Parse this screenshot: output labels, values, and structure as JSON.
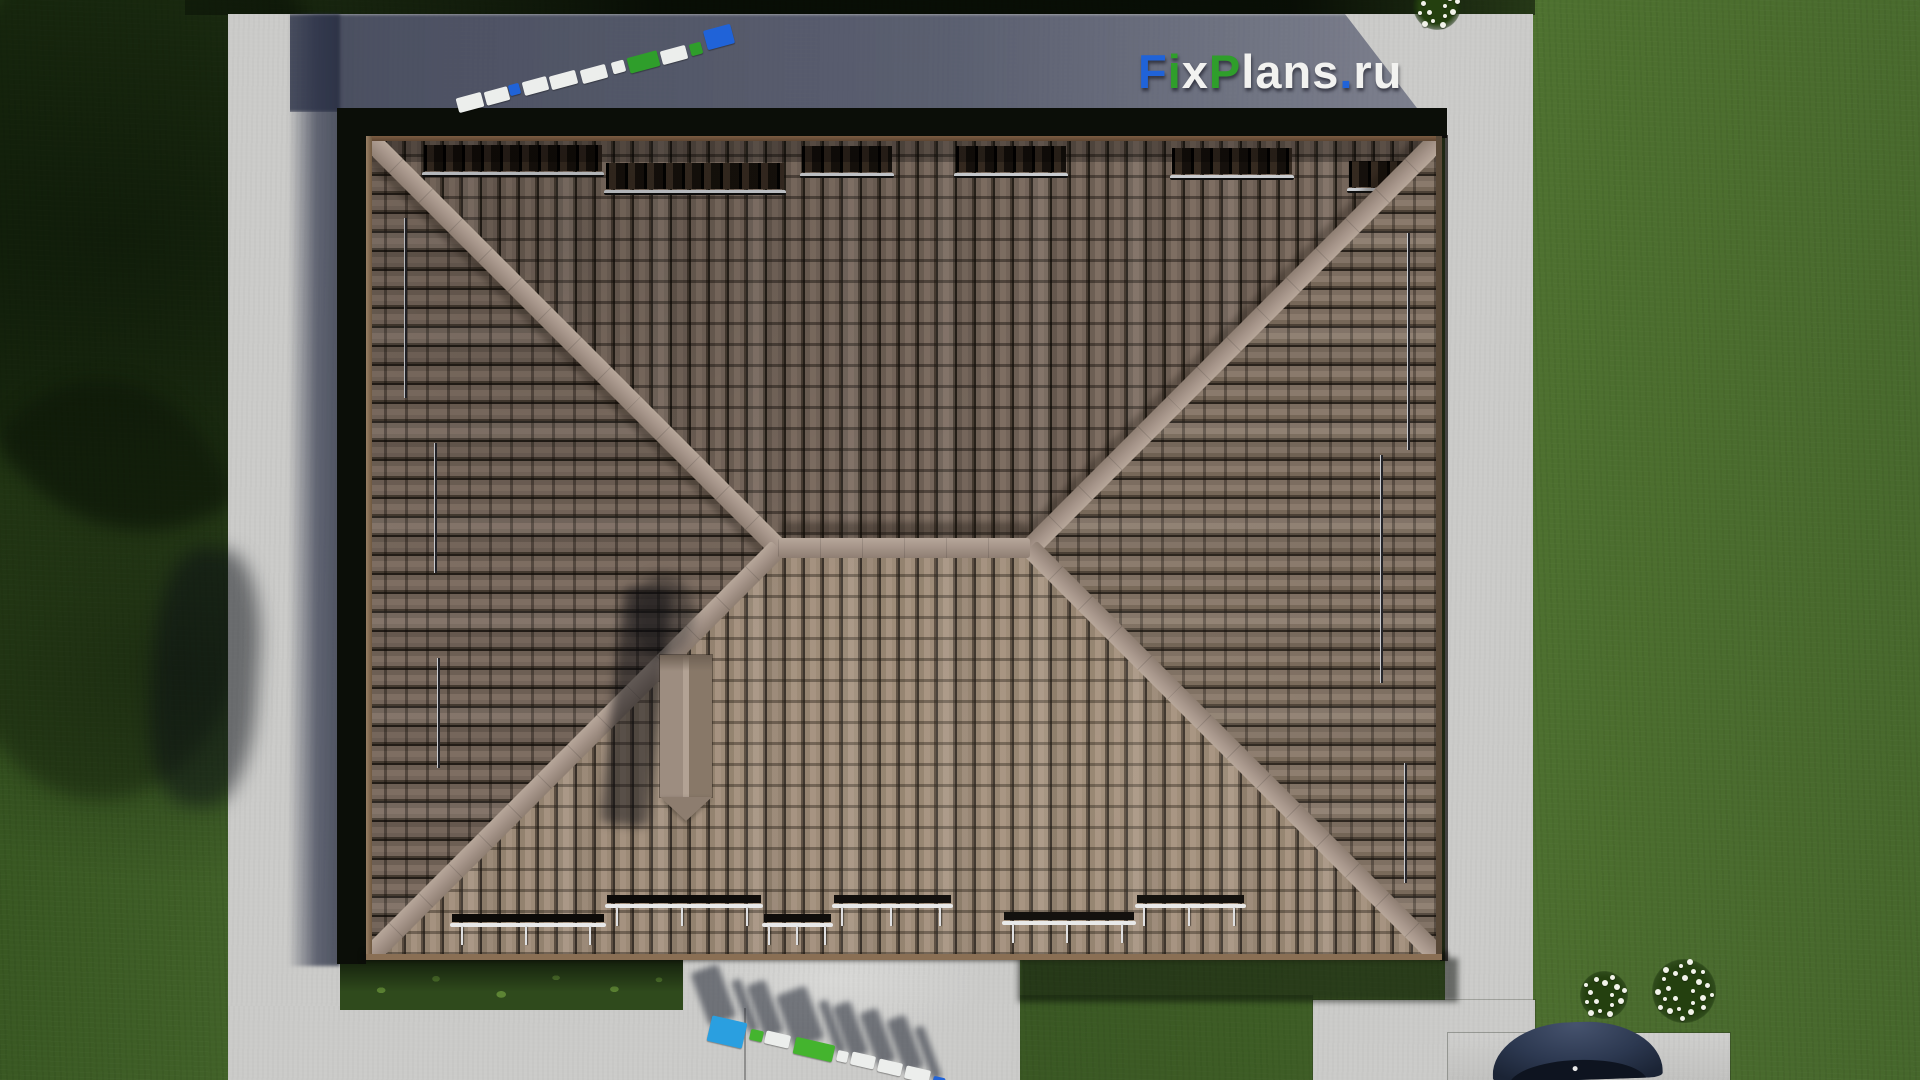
{
  "site_logo": {
    "text": "FixPlans.ru",
    "letters": [
      {
        "ch": "F",
        "color": "#2063d8"
      },
      {
        "ch": "i",
        "color": "#2f9e2b"
      },
      {
        "ch": "x",
        "color": "#f2f2f0"
      },
      {
        "ch": "P",
        "color": "#2f9e2b"
      },
      {
        "ch": "l",
        "color": "#f2f2f0"
      },
      {
        "ch": "a",
        "color": "#f2f2f0"
      },
      {
        "ch": "n",
        "color": "#f2f2f0"
      },
      {
        "ch": "s",
        "color": "#f2f2f0"
      },
      {
        "ch": ".",
        "color": "#2063d8"
      },
      {
        "ch": "r",
        "color": "#f2f2f0"
      },
      {
        "ch": "u",
        "color": "#f2f2f0"
      }
    ]
  },
  "colors": {
    "grass_base": "#46672c",
    "grass_dark": "#33511e",
    "grass_bright": "#4f7230",
    "bed_green": "#2f4a1c",
    "concrete": "#cbcbc9",
    "eave_gap": "#0b0e08",
    "tile_gap": "#262019",
    "tile_a": "#6d5f54",
    "tile_b": "#7e6e62",
    "tile_c": "#74655a",
    "tile_s_a": "#93826f",
    "tile_s_b": "#a59280",
    "tile_s_c": "#9c8a77",
    "tile_r_a": "#7c6d60",
    "tile_r_b": "#8a7a6c",
    "tile_r_c": "#766758",
    "ridge": "#a6958a",
    "ridge_light": "#b7a79a",
    "ridge_dark": "#8e7e72",
    "chimney_a": "#9d8d80",
    "chimney_b": "#887868",
    "fascia": "#6f5640",
    "guard_bar": "#c9ccd0",
    "guard_dark": "#0c0a08",
    "car_body": "#2c3850",
    "car_glass": "#0e1420",
    "flower": "#f2f3ea",
    "bush": "#24400f",
    "logo_blue": "#2063d8",
    "logo_green": "#2f9e2b",
    "logo_green2": "#44b42e",
    "logo_white": "#eceeec",
    "logo_cyan": "#2a9fe0"
  },
  "roof": {
    "snow_guards_top": [
      {
        "x": 58,
        "w": 178,
        "y": 36
      },
      {
        "x": 240,
        "w": 178,
        "y": 54
      },
      {
        "x": 436,
        "w": 90,
        "y": 37
      },
      {
        "x": 590,
        "w": 110,
        "y": 37
      },
      {
        "x": 806,
        "w": 120,
        "y": 39
      },
      {
        "x": 983,
        "w": 98,
        "y": 52
      }
    ],
    "snow_guards_bottom": [
      {
        "x": 86,
        "w": 152,
        "y": 787
      },
      {
        "x": 241,
        "w": 154,
        "y": 768
      },
      {
        "x": 398,
        "w": 67,
        "y": 787
      },
      {
        "x": 468,
        "w": 117,
        "y": 768
      },
      {
        "x": 638,
        "w": 130,
        "y": 785
      },
      {
        "x": 771,
        "w": 107,
        "y": 768
      }
    ],
    "snow_guards_left": [
      {
        "x": 38,
        "y": 82,
        "len": 180
      },
      {
        "x": 68,
        "y": 307,
        "len": 130
      },
      {
        "x": 71,
        "y": 522,
        "len": 110
      }
    ],
    "snow_guards_right": [
      {
        "x": 1041,
        "y": 97,
        "len": 217
      },
      {
        "x": 1014,
        "y": 319,
        "len": 228
      },
      {
        "x": 1038,
        "y": 627,
        "len": 120
      }
    ]
  },
  "ground_logos": {
    "northwest": {
      "rotation": -15,
      "shadows": false,
      "blocks": [
        {
          "x": 457,
          "y": 95,
          "w": 26,
          "h": 15,
          "c": "white"
        },
        {
          "x": 485,
          "y": 89,
          "w": 24,
          "h": 14,
          "c": "white"
        },
        {
          "x": 509,
          "y": 84,
          "w": 11,
          "h": 11,
          "c": "blue"
        },
        {
          "x": 523,
          "y": 79,
          "w": 25,
          "h": 14,
          "c": "white"
        },
        {
          "x": 550,
          "y": 73,
          "w": 27,
          "h": 14,
          "c": "white"
        },
        {
          "x": 581,
          "y": 67,
          "w": 26,
          "h": 14,
          "c": "white"
        },
        {
          "x": 612,
          "y": 61,
          "w": 13,
          "h": 12,
          "c": "white"
        },
        {
          "x": 628,
          "y": 54,
          "w": 31,
          "h": 16,
          "c": "green"
        },
        {
          "x": 661,
          "y": 48,
          "w": 26,
          "h": 14,
          "c": "white"
        },
        {
          "x": 690,
          "y": 43,
          "w": 12,
          "h": 12,
          "c": "green"
        },
        {
          "x": 705,
          "y": 27,
          "w": 28,
          "h": 20,
          "c": "blue"
        }
      ]
    },
    "south": {
      "rotation": 13,
      "shadows": true,
      "blocks": [
        {
          "x": 709,
          "y": 1019,
          "w": 36,
          "h": 26,
          "c": "cyan"
        },
        {
          "x": 750,
          "y": 1030,
          "w": 13,
          "h": 11,
          "c": "green2"
        },
        {
          "x": 765,
          "y": 1033,
          "w": 25,
          "h": 13,
          "c": "white"
        },
        {
          "x": 794,
          "y": 1041,
          "w": 40,
          "h": 17,
          "c": "green2"
        },
        {
          "x": 837,
          "y": 1051,
          "w": 11,
          "h": 11,
          "c": "white"
        },
        {
          "x": 851,
          "y": 1054,
          "w": 24,
          "h": 13,
          "c": "white"
        },
        {
          "x": 878,
          "y": 1061,
          "w": 24,
          "h": 13,
          "c": "white"
        },
        {
          "x": 905,
          "y": 1068,
          "w": 25,
          "h": 13,
          "c": "white"
        },
        {
          "x": 933,
          "y": 1077,
          "w": 12,
          "h": 8,
          "c": "blue"
        }
      ]
    }
  },
  "flower_beds": [
    {
      "cx": 1437,
      "cy": 6,
      "r": 24,
      "dots": 16
    },
    {
      "cx": 1604,
      "cy": 995,
      "r": 24,
      "dots": 15
    },
    {
      "cx": 1684,
      "cy": 991,
      "r": 32,
      "dots": 24
    }
  ]
}
